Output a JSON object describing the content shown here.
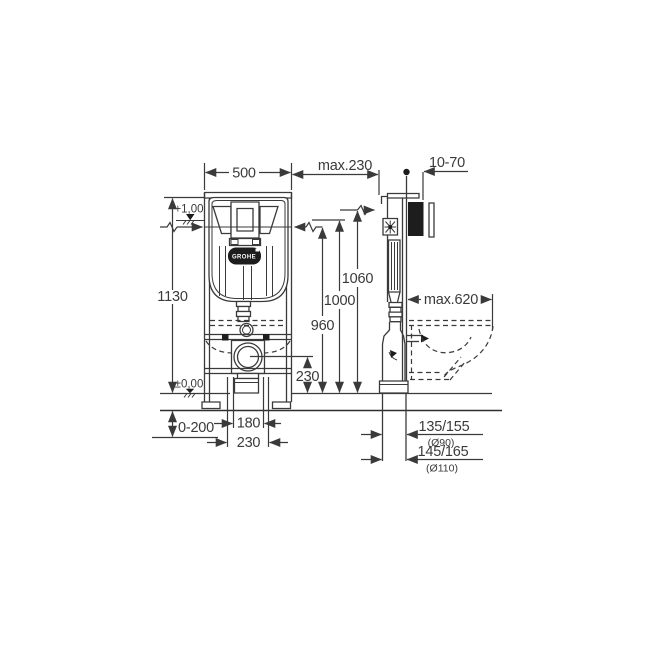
{
  "drawing": {
    "brand": "GROHE",
    "dims": {
      "width": "500",
      "height": "1130",
      "wall_offset": "max.230",
      "plate_depth": "10-70",
      "h1060": "1060",
      "h1000": "1000",
      "h960": "960",
      "drain_height": "230",
      "foot_adjust": "0-200",
      "span180": "180",
      "span230": "230",
      "bowl_depth": "max.620",
      "outlet1": "135/155",
      "outlet1_dia": "(Ø90)",
      "outlet2": "145/165",
      "outlet2_dia": "(Ø110)"
    },
    "levels": {
      "actuation": "+1,00",
      "floor": "±0,00"
    }
  }
}
